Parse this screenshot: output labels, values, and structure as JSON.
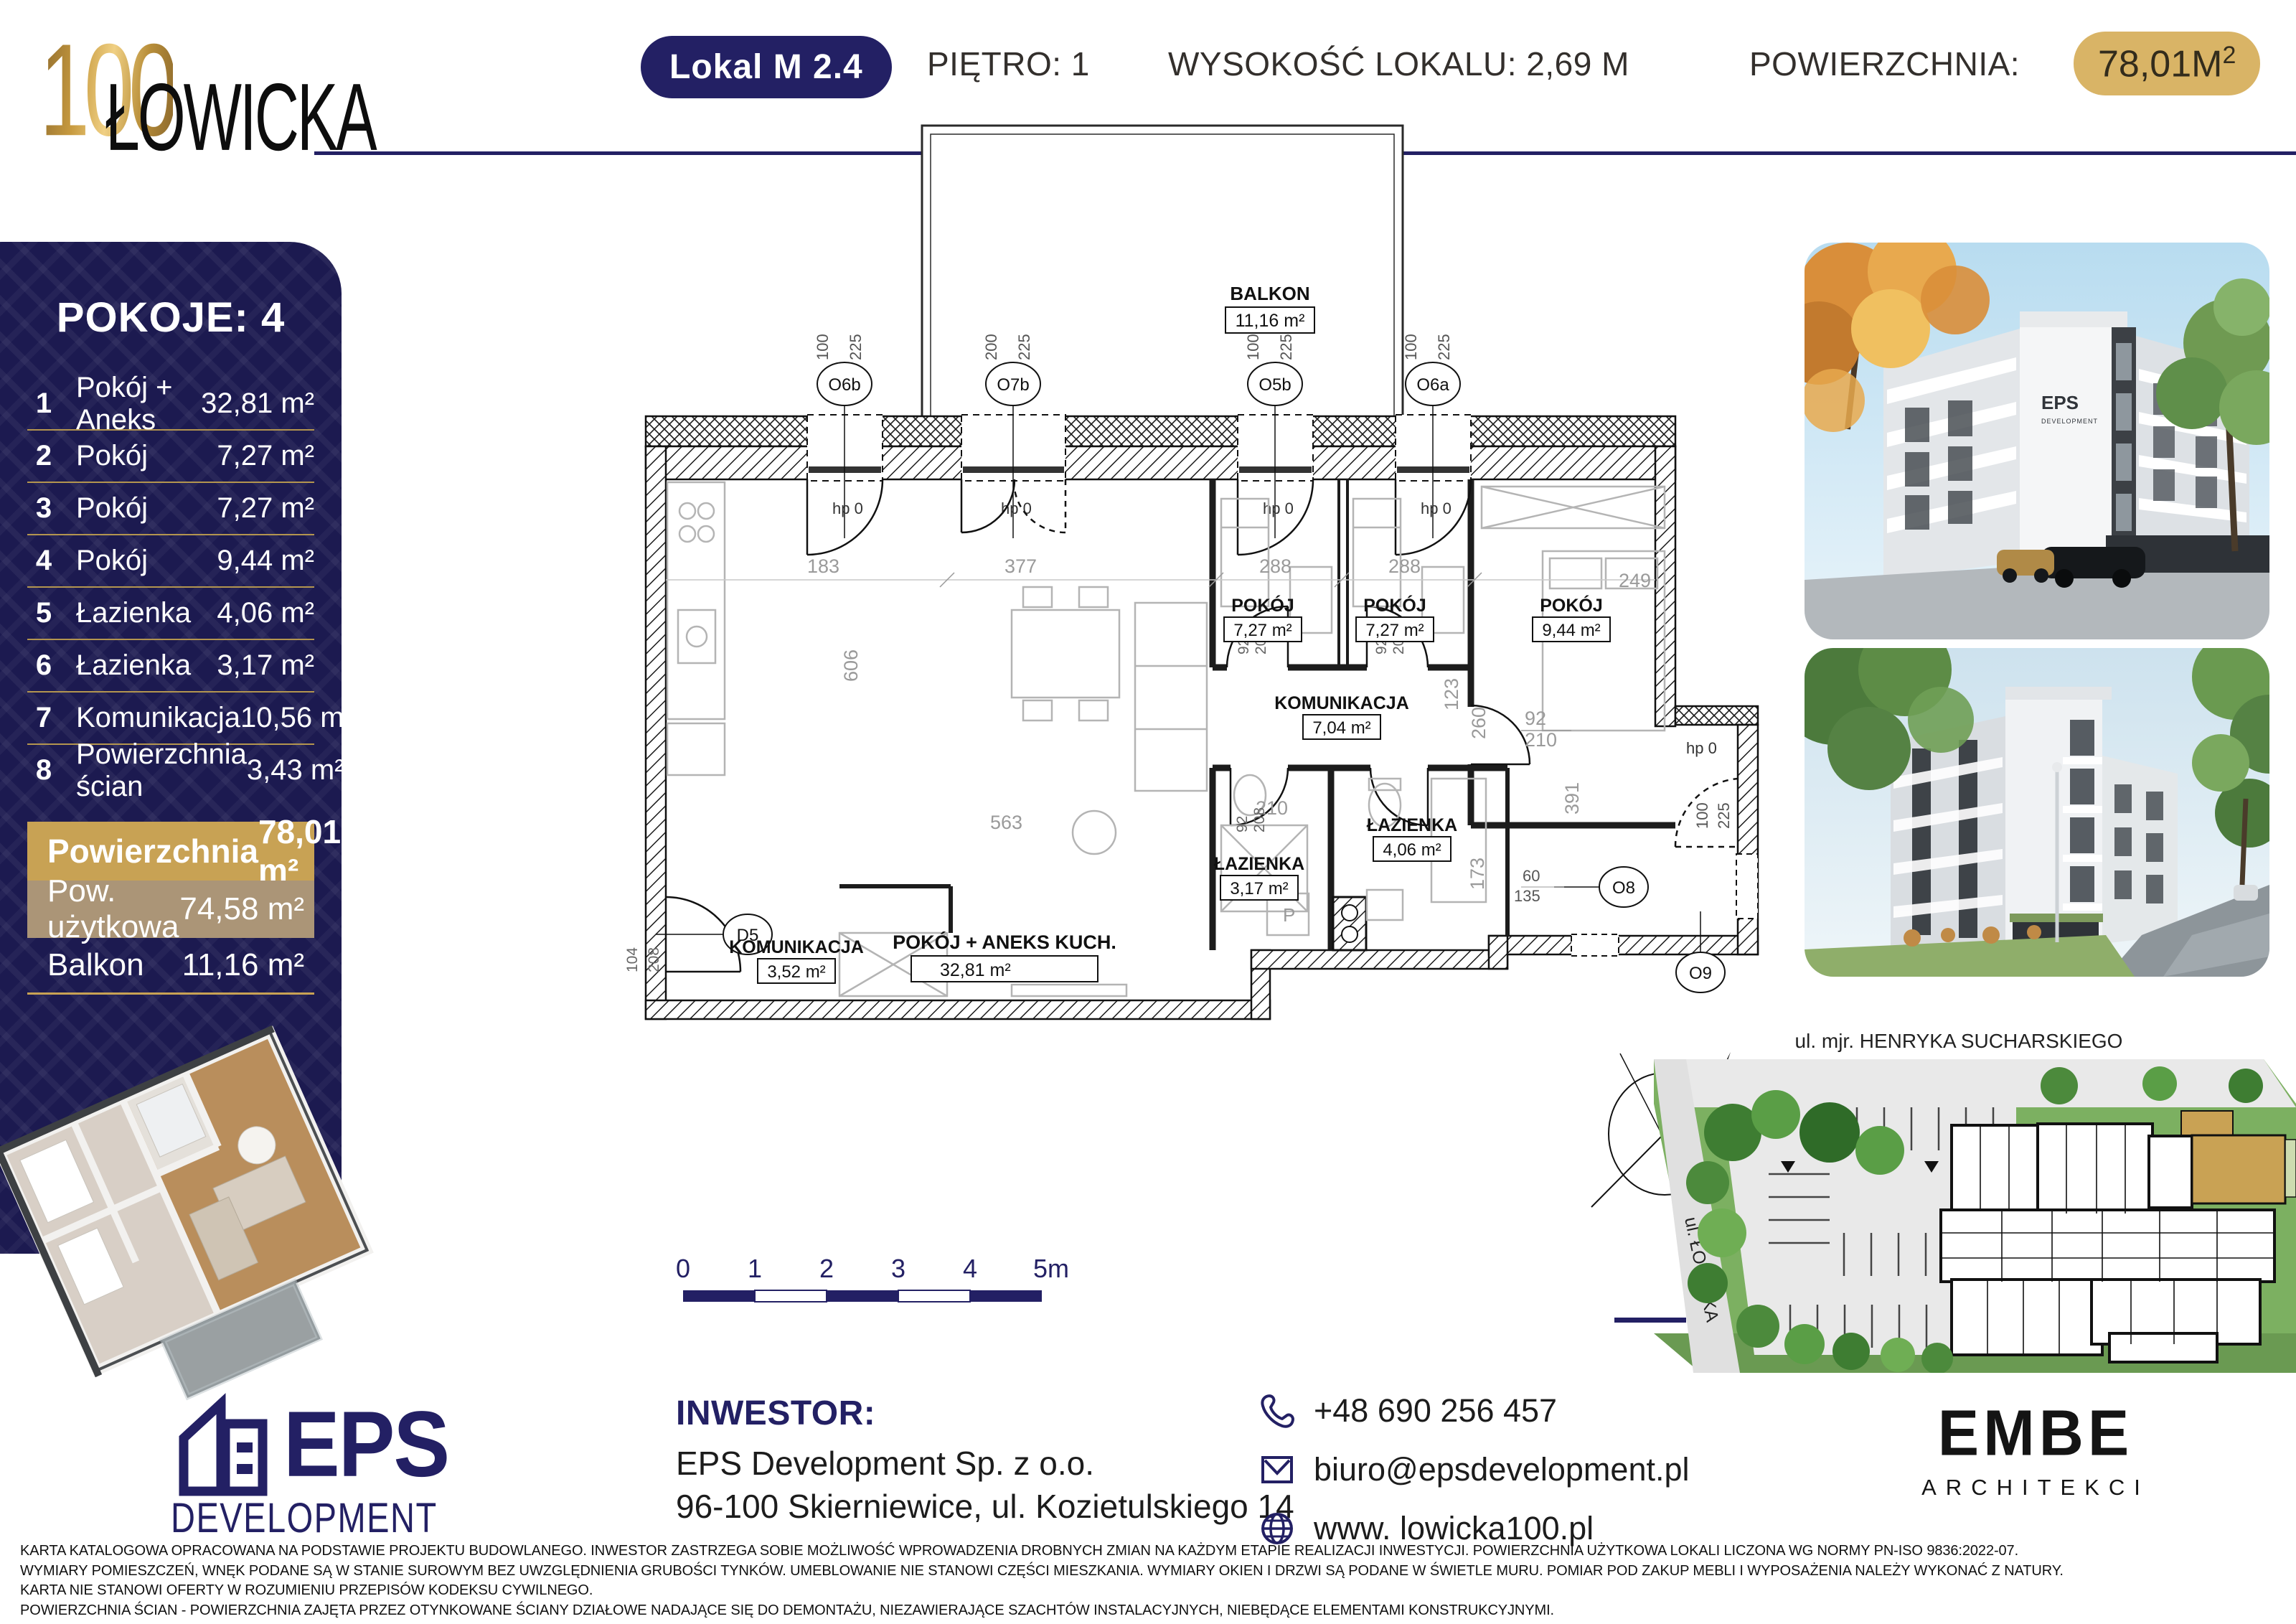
{
  "header": {
    "logo_number": "100",
    "logo_name": "ŁOWICKA",
    "unit_badge": "Lokal M 2.4",
    "floor": "PIĘTRO: 1",
    "height": "WYSOKOŚĆ LOKALU: 2,69 M",
    "area_label": "POWIERZCHNIA:",
    "area_value": "78,01M",
    "area_sup": "2"
  },
  "sidebar": {
    "title": "POKOJE: 4",
    "rows": [
      {
        "num": "1",
        "label": "Pokój + Aneks",
        "value": "32,81 m²"
      },
      {
        "num": "2",
        "label": "Pokój",
        "value": "7,27 m²"
      },
      {
        "num": "3",
        "label": "Pokój",
        "value": "7,27 m²"
      },
      {
        "num": "4",
        "label": "Pokój",
        "value": "9,44 m²"
      },
      {
        "num": "5",
        "label": "Łazienka",
        "value": "4,06 m²"
      },
      {
        "num": "6",
        "label": "Łazienka",
        "value": "3,17 m²"
      },
      {
        "num": "7",
        "label": "Komunikacja",
        "value": "10,56 m²"
      },
      {
        "num": "8",
        "label": "Powierzchnia ścian",
        "value": "3,43 m²"
      }
    ],
    "total": {
      "label": "Powierzchnia",
      "value": "78,01 m²"
    },
    "usable": {
      "label": "Pow. użytkowa",
      "value": "74,58 m²"
    },
    "balcony": {
      "label": "Balkon",
      "value": "11,16 m²"
    }
  },
  "plan": {
    "rooms": {
      "balkon": {
        "name": "BALKON",
        "area": "11,16 m²"
      },
      "living": {
        "name": "POKÓJ + ANEKS KUCH.",
        "area": "32,81 m²"
      },
      "pokoj2": {
        "name": "POKÓJ",
        "area": "7,27 m²"
      },
      "pokoj3": {
        "name": "POKÓJ",
        "area": "7,27 m²"
      },
      "pokoj4": {
        "name": "POKÓJ",
        "area": "9,44 m²"
      },
      "kom1": {
        "name": "KOMUNIKACJA",
        "area": "7,04 m²"
      },
      "laz1": {
        "name": "ŁAZIENKA",
        "area": "4,06 m²"
      },
      "laz2": {
        "name": "ŁAZIENKA",
        "area": "3,17 m²"
      },
      "kom2": {
        "name": "KOMUNIKACJA",
        "area": "3,52 m²"
      }
    },
    "windows": {
      "o6b": "O6b",
      "o7b": "O7b",
      "o5b": "O5b",
      "o6a": "O6a",
      "o8": "O8",
      "o9": "O9",
      "d5": "D5"
    },
    "hp": "hp 0",
    "letter_p": "P",
    "dims": {
      "d183": "183",
      "d377": "377",
      "d288": "288",
      "d249": "249",
      "d563": "563",
      "d606": "606",
      "d391": "391",
      "d260": "260",
      "d173": "173",
      "d123": "123",
      "d210": "210",
      "d92": "92",
      "d208": "208",
      "d104": "104",
      "d60": "60",
      "d135": "135",
      "d100": "100",
      "d225": "225",
      "d200": "200"
    },
    "scale": [
      "0",
      "1",
      "2",
      "3",
      "4",
      "5m"
    ]
  },
  "photos": {
    "building_logo": "EPS",
    "building_logo_sub": "DEVELOPMENT"
  },
  "sitemap": {
    "street_top": "ul. mjr. HENRYKA SUCHARSKIEGO",
    "street_left": "ul. ŁOWICKA"
  },
  "footer": {
    "eps_name": "EPS",
    "eps_sub": "DEVELOPMENT",
    "investor_heading": "INWESTOR:",
    "investor_name": "EPS Development Sp. z o.o.",
    "investor_address": "96-100 Skierniewice, ul. Kozietulskiego 14",
    "phone": "+48 690 256 457",
    "email": "biuro@epsdevelopment.pl",
    "website": "www. lowicka100.pl",
    "embe_name": "EMBE",
    "embe_sub": "ARCHITEKCI"
  },
  "disclaimer": [
    "KARTA KATALOGOWA OPRACOWANA NA PODSTAWIE PROJEKTU BUDOWLANEGO. INWESTOR ZASTRZEGA SOBIE MOŻLIWOŚĆ WPROWADZENIA DROBNYCH ZMIAN NA KAŻDYM ETAPIE REALIZACJI INWESTYCJI. POWIERZCHNIA UŻYTKOWA LOKALI LICZONA WG NORMY PN-ISO 9836:2022-07.",
    "WYMIARY POMIESZCZEŃ, WNĘK PODANE SĄ W STANIE SUROWYM BEZ UWZGLĘDNIENIA GRUBOŚCI TYNKÓW. UMEBLOWANIE NIE STANOWI CZĘŚCI MIESZKANIA. WYMIARY OKIEN I DRZWI SĄ PODANE W ŚWIETLE MURU. POMIAR POD ZAKUP MEBLI I WYPOSAŻENIA NALEŻY WYKONAĆ Z NATURY.",
    "KARTA NIE STANOWI OFERTY W ROZUMIENIU PRZEPISÓW KODEKSU CYWILNEGO.",
    "POWIERZCHNIA ŚCIAN - POWIERZCHNIA ZAJĘTA PRZEZ OTYNKOWANE ŚCIANY DZIAŁOWE NADAJĄCE SIĘ DO DEMONTAŻU, NIEZAWIERAJĄCE SZACHTÓW INSTALACYJNYCH, NIEBĘDĄCE ELEMENTAMI KONSTRUKCYJNYMI."
  ]
}
